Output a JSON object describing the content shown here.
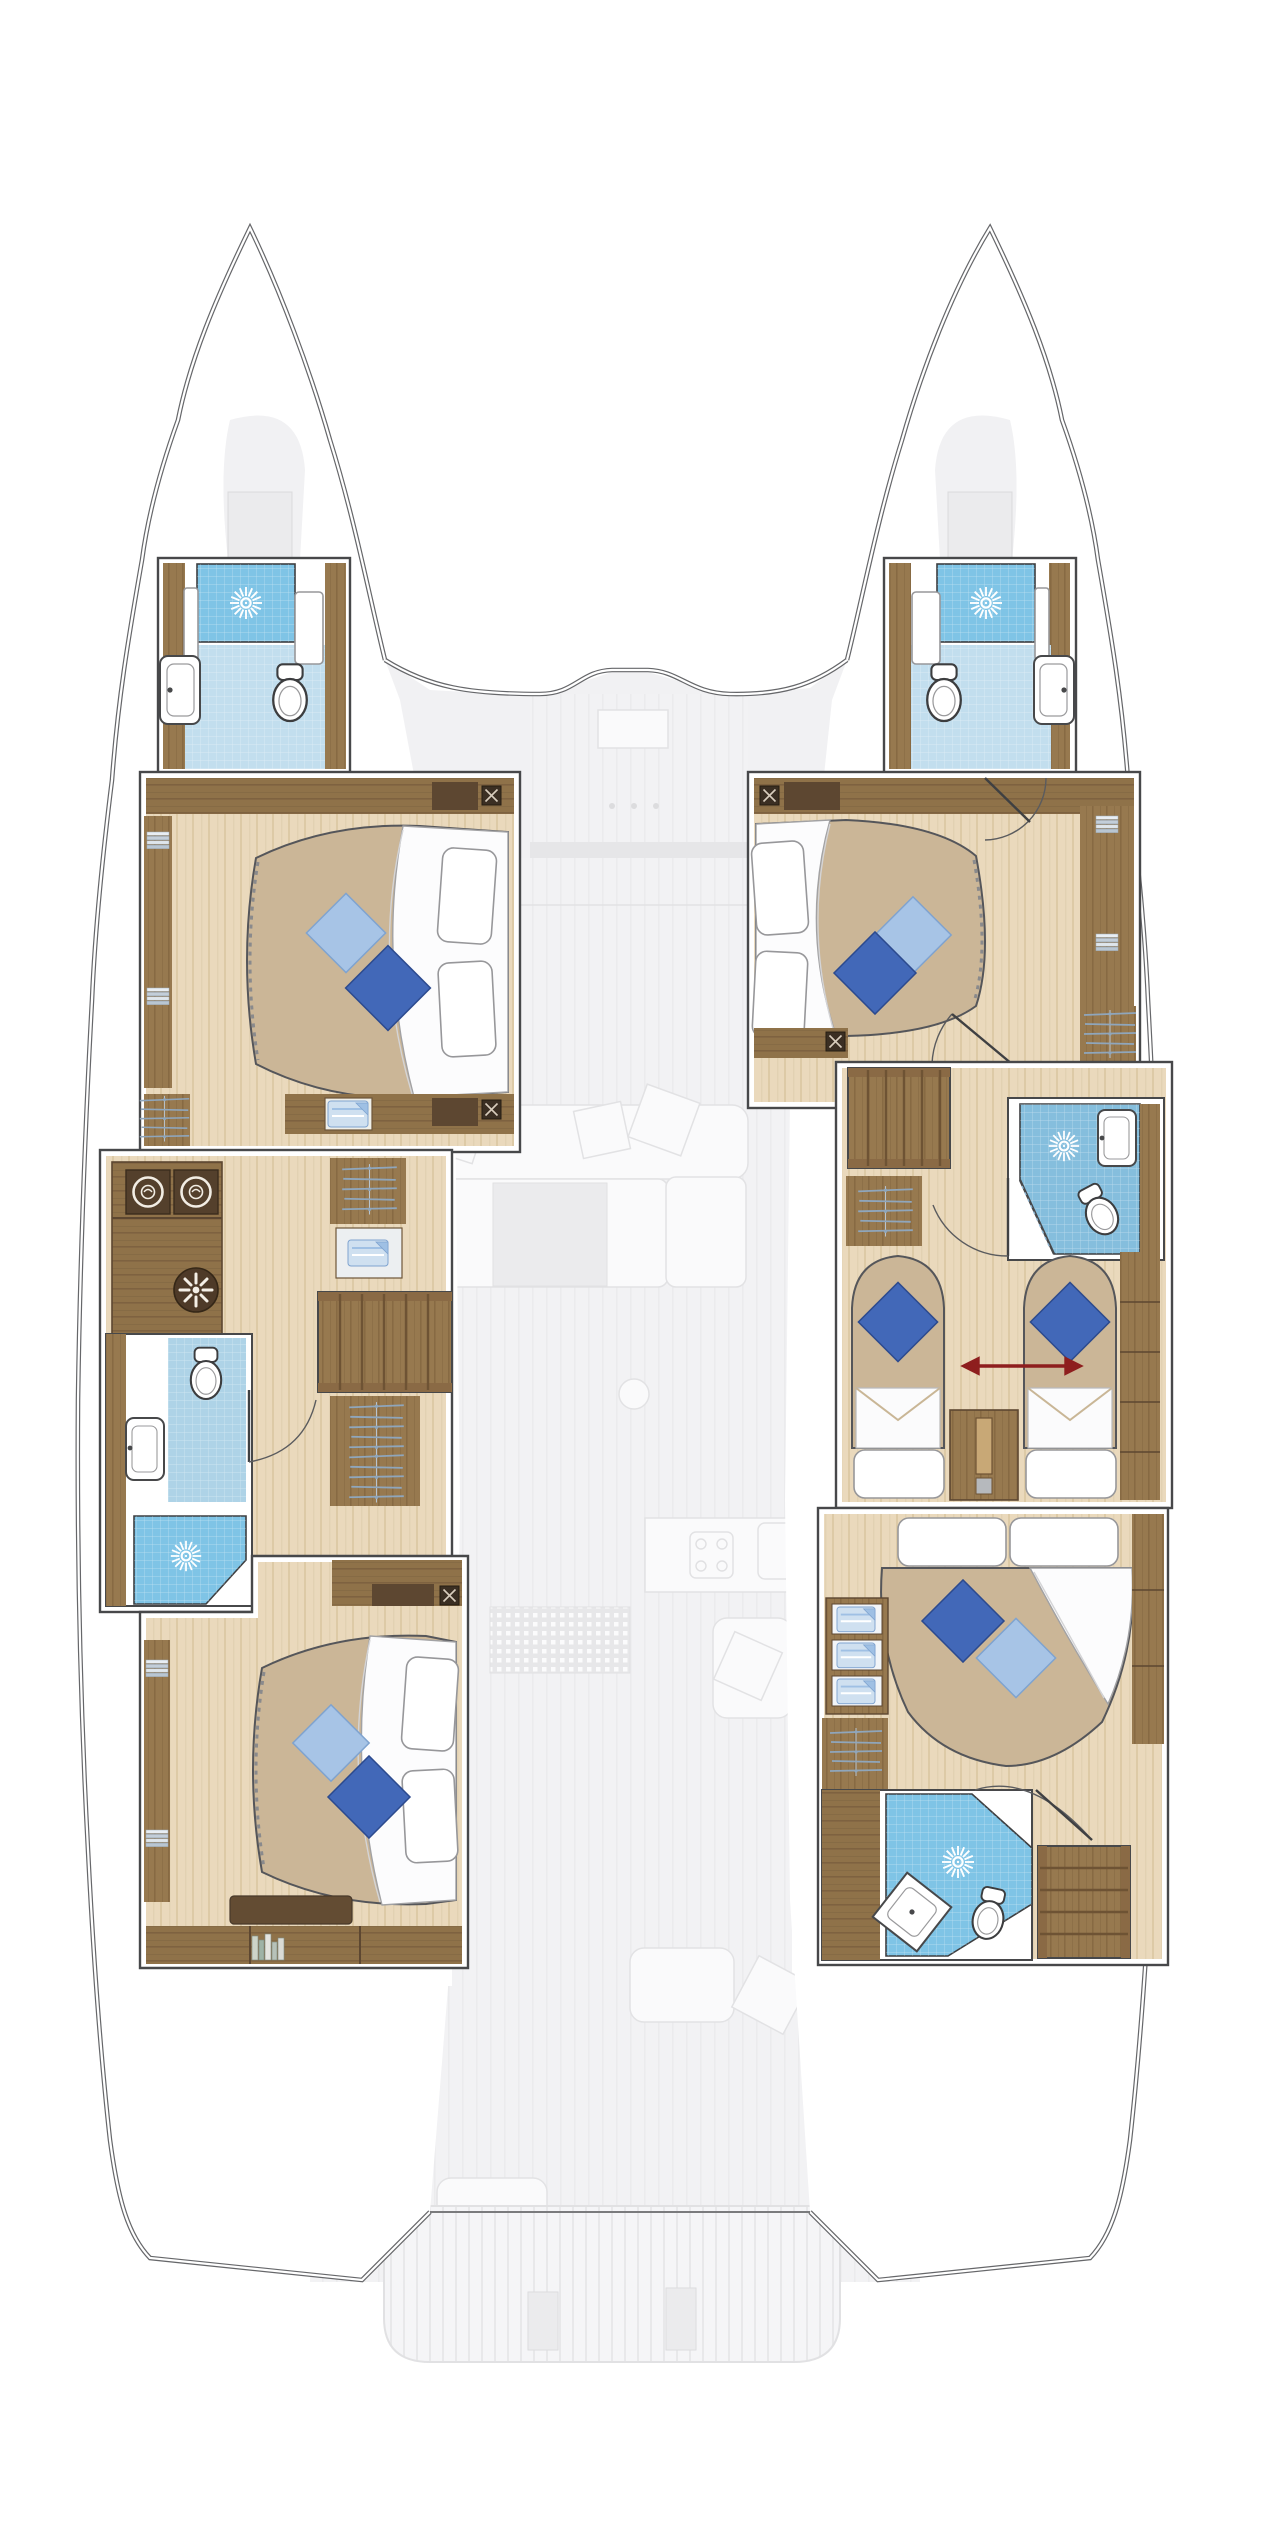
{
  "image_type": "Catamaran yacht lower-deck floor plan (hull cabins in colour, main deck faded)",
  "palette": {
    "line": "#47484a",
    "line-soft": "#8b8b8d",
    "hull-line": "#66676a",
    "wood": "#97794f",
    "wood-dark": "#7a5e40",
    "wood-deep": "#5d4731",
    "wood-light": "#b99a6d",
    "floor-plank": "#e3d2b3",
    "floor-plank-stripe": "#d6c29e",
    "mattress": "#cbb697",
    "cushion-dark": "#4268b8",
    "cushion-light": "#a7c4e6",
    "blue-shower": "#7fc4e6",
    "blue-shower-mid": "#85bedd",
    "blue-tile": "#c2deee",
    "blue-tile2": "#aed3e7",
    "towel": "#9fc0e4",
    "hanger": "#8fa6bc",
    "faded": "#f1f1f3",
    "faded2": "#ebebed",
    "faded-stroke": "#e2e2e4",
    "arrow": "#8e1e1e"
  },
  "port_hull": {
    "rooms": [
      {
        "id": "port-forward-bathroom",
        "features": [
          "shower",
          "toilet",
          "sink"
        ]
      },
      {
        "id": "port-forward-cabin",
        "features": [
          "double-bed",
          "2-pillows",
          "2-cushions",
          "wardrobe",
          "nightstands"
        ]
      },
      {
        "id": "port-utility-area",
        "features": [
          "washer",
          "dryer",
          "extractor-fan",
          "counter"
        ]
      },
      {
        "id": "port-mid-bathroom",
        "features": [
          "shower",
          "toilet",
          "sink"
        ]
      },
      {
        "id": "port-companionway-stairs",
        "features": [
          "6-treads"
        ]
      },
      {
        "id": "port-aft-cabin",
        "features": [
          "double-bed",
          "2-pillows",
          "2-cushions",
          "bookshelf",
          "bench"
        ]
      }
    ]
  },
  "starboard_hull": {
    "rooms": [
      {
        "id": "starboard-forward-bathroom",
        "features": [
          "shower",
          "toilet",
          "sink"
        ]
      },
      {
        "id": "starboard-forward-cabin",
        "features": [
          "double-bed",
          "2-pillows",
          "2-cushions",
          "wardrobe",
          "shelves"
        ]
      },
      {
        "id": "starboard-companionway-stairs",
        "features": [
          "treads"
        ]
      },
      {
        "id": "starboard-mid-bathroom",
        "features": [
          "shower",
          "toilet",
          "sink",
          "glass-partition"
        ]
      },
      {
        "id": "starboard-twin-cabin",
        "features": [
          "two-single-beds",
          "convertible-arrow",
          "center-console",
          "wardrobe"
        ]
      },
      {
        "id": "starboard-aft-cabin",
        "features": [
          "double-bed",
          "2-pillows",
          "2-cushions",
          "linen-lockers",
          "wardrobe"
        ]
      },
      {
        "id": "starboard-aft-bathroom",
        "features": [
          "shower",
          "toilet",
          "corner-sink",
          "stairs"
        ]
      }
    ]
  },
  "center_faded_areas": [
    {
      "id": "foredeck-console"
    },
    {
      "id": "salon-sofa"
    },
    {
      "id": "salon-table"
    },
    {
      "id": "galley-counter-with-stove-and-sink"
    },
    {
      "id": "galley-floor-mat"
    },
    {
      "id": "nav-seat"
    },
    {
      "id": "cockpit-benches"
    },
    {
      "id": "swim-platform-with-davits"
    }
  ],
  "icons": [
    "shower-head-icon",
    "toilet-icon",
    "sink-icon",
    "washer-icon",
    "dryer-icon",
    "extractor-fan-icon",
    "hanging-wardrobe-icon",
    "linen-shelf-icon",
    "towel-stack-icon",
    "books-icon",
    "speaker-grille-icon",
    "door-swing-icon",
    "stairs-icon",
    "convertible-bed-arrow-icon"
  ]
}
